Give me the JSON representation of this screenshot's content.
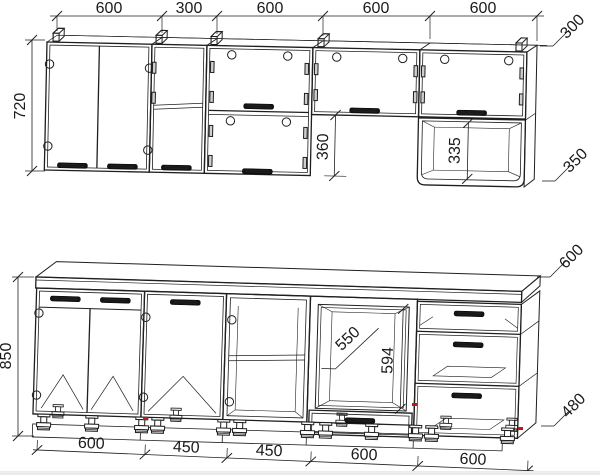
{
  "drawing": {
    "background": "#ffffff",
    "line_color": "#1f1f1f",
    "accent_red": "#c31414",
    "wall_units": {
      "width_labels": [
        "600",
        "300",
        "600",
        "600",
        "600"
      ],
      "height_label": "720",
      "under_hood_gap_label": "360",
      "open_niche_height_label": "335",
      "top_depth_label": "300",
      "niche_depth_label": "350"
    },
    "base_units": {
      "height_label": "850",
      "width_labels": [
        "600",
        "450",
        "450",
        "600",
        "600"
      ],
      "oven_niche_depth_label": "550",
      "oven_niche_height_label": "594",
      "worktop_depth_label": "600",
      "carcass_depth_label": "480"
    }
  }
}
